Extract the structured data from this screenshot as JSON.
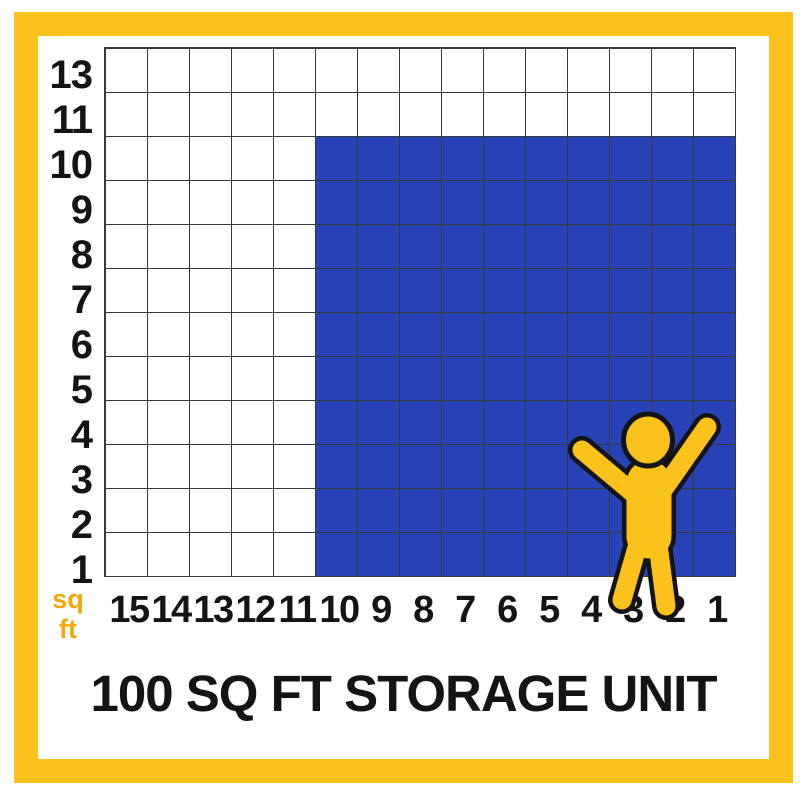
{
  "title": "100 SQ FT STORAGE UNIT",
  "axis_unit": {
    "line1": "sq",
    "line2": "ft"
  },
  "grid": {
    "columns": 15,
    "rows": 12,
    "row_labels": [
      "13",
      "11",
      "10",
      "9",
      "8",
      "7",
      "6",
      "5",
      "4",
      "3",
      "2",
      "1"
    ],
    "col_labels": [
      "15",
      "14",
      "13",
      "12",
      "11",
      "10",
      "9",
      "8",
      "7",
      "6",
      "5",
      "4",
      "3",
      "2",
      "1"
    ],
    "highlight": {
      "col_start": 6,
      "col_span": 10,
      "row_start": 3,
      "row_span": 10
    }
  },
  "icons": {
    "person": "person-arms-raised-icon"
  },
  "colors": {
    "yellow": "#FBC21B",
    "amber": "#F0A80D",
    "blue": "#2843B7",
    "ink": "#141414",
    "line": "#383838"
  }
}
